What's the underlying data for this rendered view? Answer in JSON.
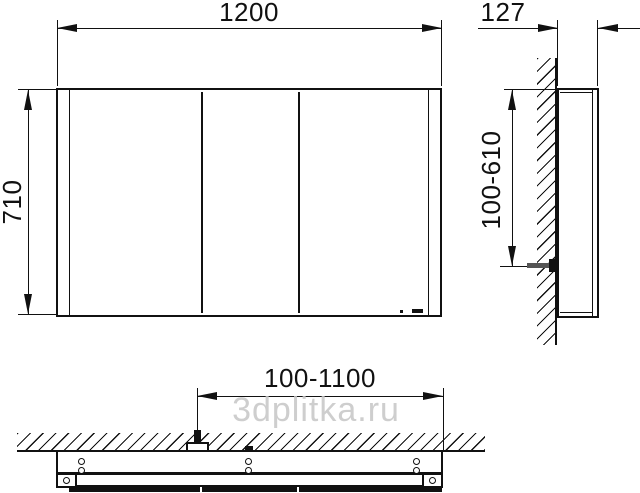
{
  "watermark": {
    "text": "3dplitka.ru",
    "color": "#c6c6c6"
  },
  "drawing": {
    "type": "technical-dimension-drawing",
    "subject": "mirror cabinet, three views (front, side, bottom)",
    "front_view": {
      "width_dim": "1200",
      "height_dim": "710",
      "door_count": 3
    },
    "side_view": {
      "depth_dim": "127",
      "mounting_height_range_dim": "100-610"
    },
    "bottom_view": {
      "mounting_width_range_dim": "100-1100"
    },
    "colors": {
      "line": "#111111",
      "background": "#ffffff"
    }
  }
}
